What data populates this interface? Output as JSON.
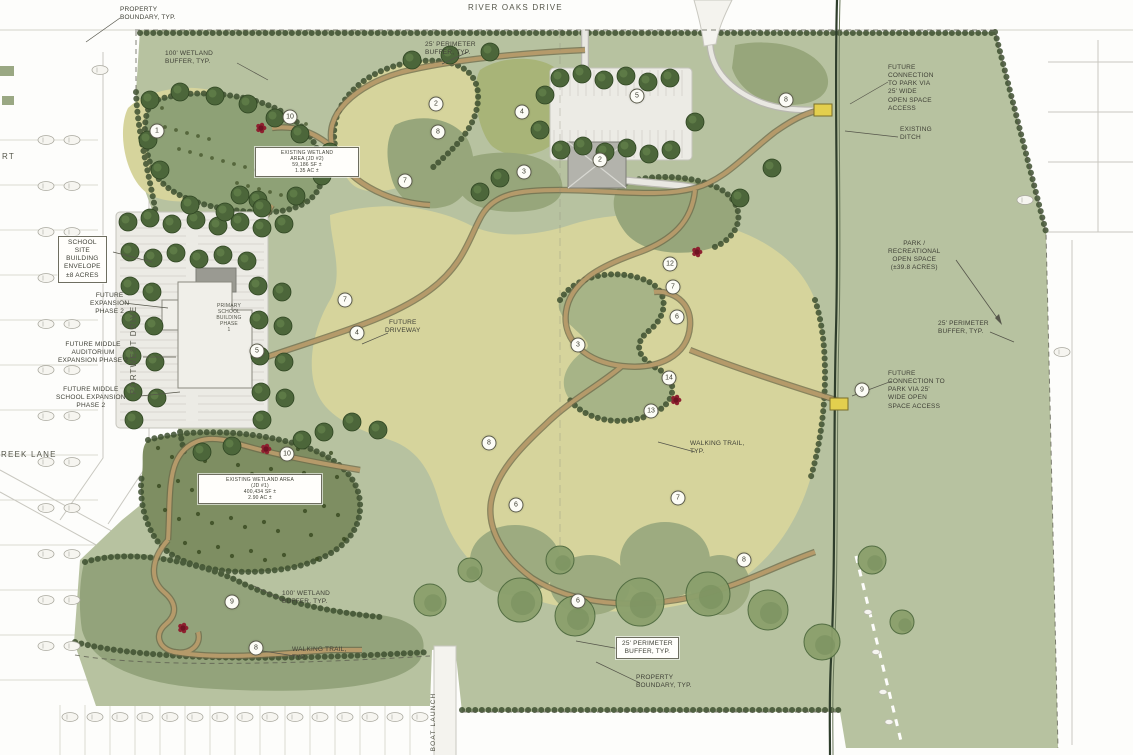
{
  "streets": {
    "river_oaks_drive": "RIVER OAKS DRIVE",
    "portwest_drive": "PORTWEST DRIVE",
    "creek_lane": "CREEK LANE",
    "court_fragment": "RT",
    "boat_launch": "BOAT LAUNCH"
  },
  "callouts": {
    "property_boundary_top": [
      "PROPERTY",
      "BOUNDARY, TYP."
    ],
    "perimeter_buffer_top": [
      "25' PERIMETER",
      "BUFFER, TYP."
    ],
    "wetland_buffer_top": [
      "100' WETLAND",
      "BUFFER, TYP."
    ],
    "school_site_envelope": [
      "SCHOOL",
      "SITE",
      "BUILDING",
      "ENVELOPE",
      "±8 ACRES"
    ],
    "future_expansion_phase2": [
      "FUTURE",
      "EXPANSION",
      "PHASE 2"
    ],
    "future_middle_auditorium": [
      "FUTURE MIDDLE",
      "AUDITORIUM",
      "EXPANSION PHASE 2"
    ],
    "future_middle_school": [
      "FUTURE MIDDLE",
      "SCHOOL EXPANSION",
      "PHASE 2"
    ],
    "existing_wetland_area_2": [
      "EXISTING WETLAND",
      "AREA (JD #2)",
      "59,186 SF ±",
      "1.35 AC ±"
    ],
    "primary_school_building": [
      "PRIMARY",
      "SCHOOL",
      "BUILDING",
      "PHASE",
      "1"
    ],
    "future_driveway": [
      "FUTURE",
      "DRIVEWAY"
    ],
    "existing_wetland_area_1": [
      "EXISTING WETLAND AREA",
      "(JD #1)",
      "400,434 SF ±",
      "2.90 AC ±"
    ],
    "walking_trail_mid": [
      "WALKING TRAIL,",
      "TYP."
    ],
    "wetland_buffer_bottom": [
      "100' WETLAND",
      "BUFFER, TYP."
    ],
    "walking_trail_bottom": [
      "WALKING TRAIL,",
      "TYP."
    ],
    "perimeter_buffer_bottom": [
      "25' PERIMETER",
      "BUFFER, TYP."
    ],
    "property_boundary_bottom": [
      "PROPERTY",
      "BOUNDARY, TYP."
    ],
    "future_connection_top": [
      "FUTURE",
      "CONNECTION",
      "TO PARK VIA",
      "25' WIDE",
      "OPEN SPACE",
      "ACCESS"
    ],
    "existing_ditch": [
      "EXISTING",
      "DITCH"
    ],
    "park_open_space": [
      "PARK /",
      "RECREATIONAL",
      "OPEN SPACE",
      "(±39.8 ACRES)"
    ],
    "perimeter_buffer_right": [
      "25' PERIMETER",
      "BUFFER, TYP."
    ],
    "future_connection_mid": [
      "FUTURE",
      "CONNECTION TO",
      "PARK VIA 25'",
      "WIDE OPEN",
      "SPACE ACCESS"
    ]
  },
  "keynotes": [
    {
      "n": "1",
      "x": 157,
      "y": 131
    },
    {
      "n": "10",
      "x": 290,
      "y": 117
    },
    {
      "n": "2",
      "x": 436,
      "y": 104
    },
    {
      "n": "8",
      "x": 438,
      "y": 132
    },
    {
      "n": "4",
      "x": 522,
      "y": 112
    },
    {
      "n": "5",
      "x": 637,
      "y": 96
    },
    {
      "n": "7",
      "x": 405,
      "y": 181
    },
    {
      "n": "3",
      "x": 524,
      "y": 172
    },
    {
      "n": "2",
      "x": 600,
      "y": 160
    },
    {
      "n": "8",
      "x": 786,
      "y": 100
    },
    {
      "n": "7",
      "x": 345,
      "y": 300
    },
    {
      "n": "4",
      "x": 357,
      "y": 333
    },
    {
      "n": "5",
      "x": 257,
      "y": 351
    },
    {
      "n": "12",
      "x": 670,
      "y": 264
    },
    {
      "n": "7",
      "x": 673,
      "y": 287
    },
    {
      "n": "6",
      "x": 677,
      "y": 317
    },
    {
      "n": "3",
      "x": 578,
      "y": 345
    },
    {
      "n": "14",
      "x": 669,
      "y": 378
    },
    {
      "n": "13",
      "x": 651,
      "y": 411
    },
    {
      "n": "9",
      "x": 862,
      "y": 390
    },
    {
      "n": "8",
      "x": 489,
      "y": 443
    },
    {
      "n": "10",
      "x": 287,
      "y": 454
    },
    {
      "n": "6",
      "x": 516,
      "y": 505
    },
    {
      "n": "7",
      "x": 678,
      "y": 498
    },
    {
      "n": "8",
      "x": 744,
      "y": 560
    },
    {
      "n": "9",
      "x": 232,
      "y": 602
    },
    {
      "n": "8",
      "x": 256,
      "y": 648
    },
    {
      "n": "6",
      "x": 578,
      "y": 601
    }
  ],
  "colors": {
    "site_green": "#b7c2a0",
    "lawn_yellow_green": "#d6d49c",
    "wetland_olive": "#8ea176",
    "tree_green": "#4c663a",
    "trail_tan": "#b59a6a",
    "marker_red": "#8e2130",
    "culvert_yellow": "#e3cf4e"
  }
}
